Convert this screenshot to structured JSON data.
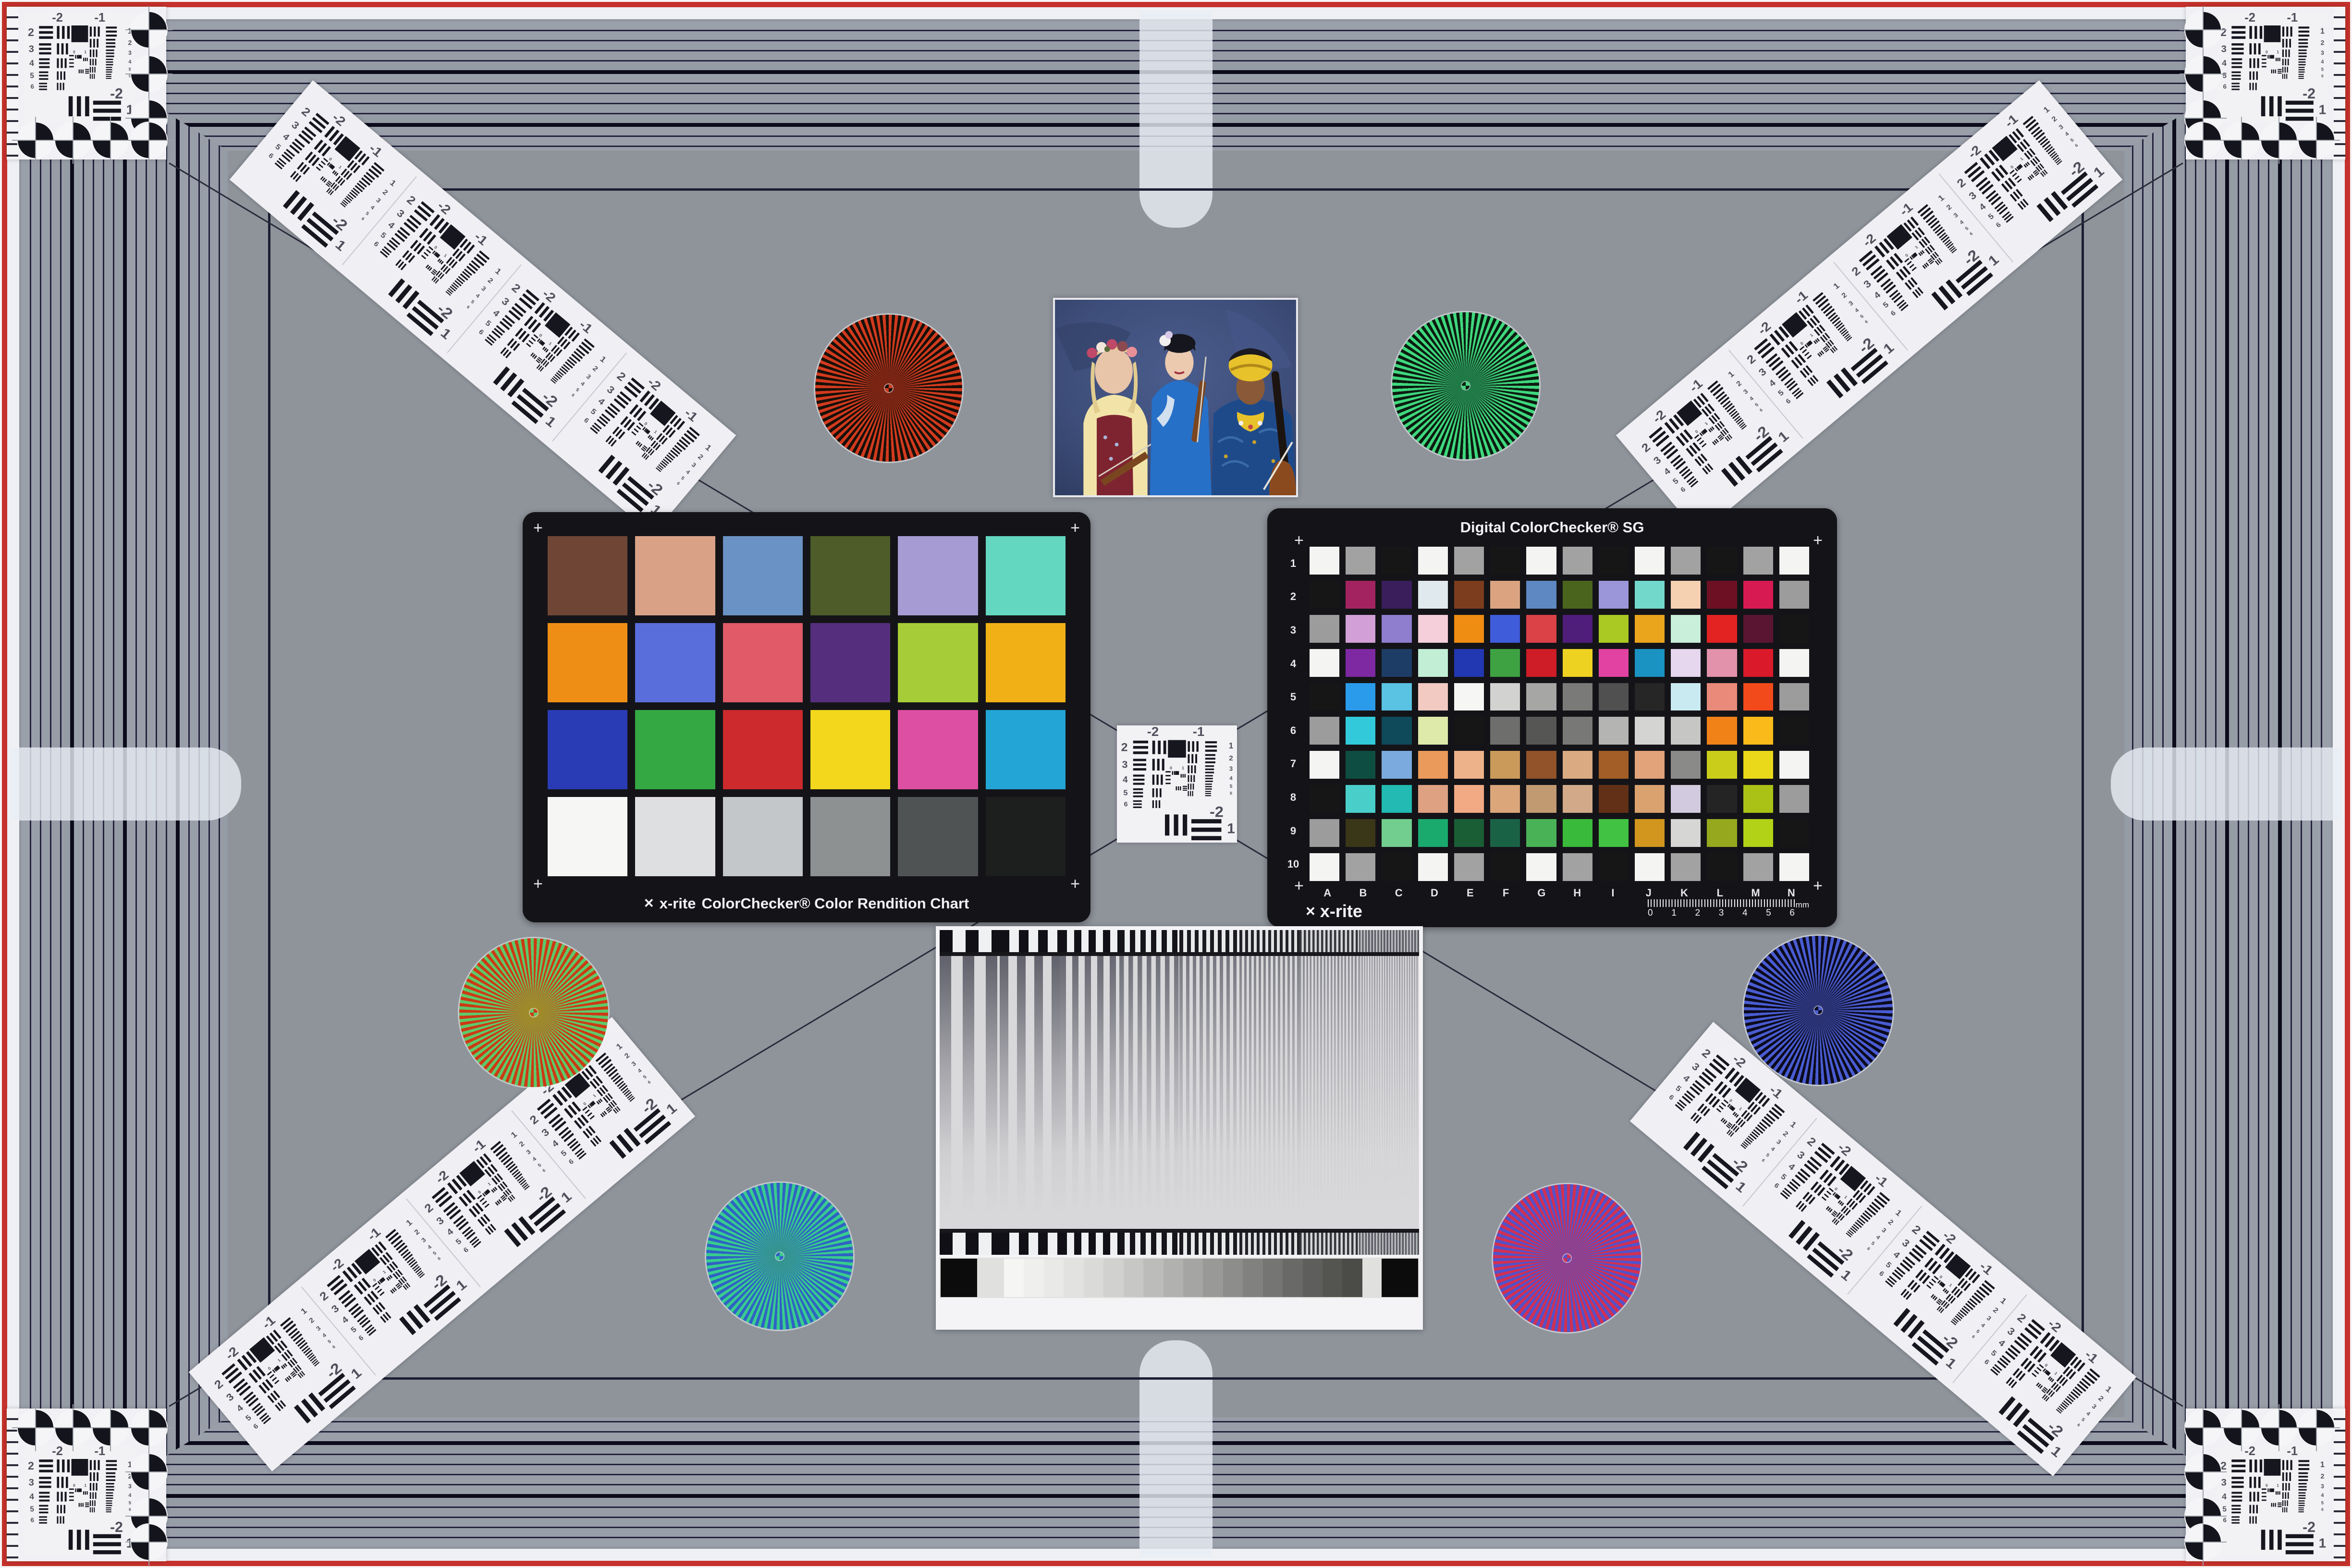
{
  "scene": {
    "background": "#8f949b",
    "border_red": "#c5312c",
    "frame_stripe": "#9aa0aa",
    "frame_line": "#23233d",
    "panel_white": "#f1f0f4"
  },
  "stars": [
    {
      "name": "red-black-star",
      "c1": "#d23a1e",
      "c2": "#171009",
      "blend": "#7a2414"
    },
    {
      "name": "green-black-star",
      "c1": "#3fd87e",
      "c2": "#0c1c10",
      "blend": "#1f7a46"
    },
    {
      "name": "red-green-star",
      "c1": "#cc3a14",
      "c2": "#5ec96a",
      "blend": "#a08a28"
    },
    {
      "name": "green-blue-star",
      "c1": "#38cc8e",
      "c2": "#2f62c4",
      "blend": "#35948f"
    },
    {
      "name": "blue-black-star",
      "c1": "#4a5cd2",
      "c2": "#0b0b1e",
      "blend": "#2a3274"
    },
    {
      "name": "red-blue-star",
      "c1": "#d23052",
      "c2": "#5252ca",
      "blend": "#8c4290"
    }
  ],
  "classic_chart": {
    "logo": "x-rite",
    "caption": "ColorChecker® Color Rendition Chart",
    "patches": [
      "#6f4636",
      "#d9a287",
      "#6a92c4",
      "#4d5c28",
      "#a79bd3",
      "#63d7c0",
      "#ef8e15",
      "#5a6edb",
      "#e05a68",
      "#552f7e",
      "#a6cd37",
      "#f0b016",
      "#2a3cb5",
      "#33a843",
      "#cc2a2d",
      "#f2d71c",
      "#dd4fa2",
      "#23a5d5",
      "#f6f6f4",
      "#dedfe1",
      "#c3c7c9",
      "#8d9192",
      "#4f5354",
      "#1d1e1e"
    ]
  },
  "sg_chart": {
    "title": "Digital ColorChecker® SG",
    "logo": "x-rite",
    "rows": [
      "1",
      "2",
      "3",
      "4",
      "5",
      "6",
      "7",
      "8",
      "9",
      "10"
    ],
    "cols": [
      "A",
      "B",
      "C",
      "D",
      "E",
      "F",
      "G",
      "H",
      "I",
      "J",
      "K",
      "L",
      "M",
      "N"
    ],
    "ruler_numbers": [
      "0",
      "1",
      "2",
      "3",
      "4",
      "5",
      "6"
    ],
    "ruler_unit": "mm",
    "patches": [
      "#f4f4f2",
      "#a2a2a2",
      "#161616",
      "#f4f4f2",
      "#a2a2a2",
      "#161616",
      "#f4f4f2",
      "#a2a2a2",
      "#161616",
      "#f4f4f2",
      "#a2a2a2",
      "#161616",
      "#a2a2a2",
      "#f4f4f2",
      "#161616",
      "#a32360",
      "#3a1e5c",
      "#dfe9ee",
      "#7c3d1e",
      "#dba380",
      "#5e88c2",
      "#4a641e",
      "#9b96da",
      "#72d8cc",
      "#f5d1b2",
      "#6e1024",
      "#d81a52",
      "#9c9c9c",
      "#9c9c9c",
      "#d2a0d6",
      "#8f7dce",
      "#f5d0da",
      "#ef8c12",
      "#3f5cda",
      "#da4248",
      "#4f1d7a",
      "#aac922",
      "#eaa51c",
      "#c9eed9",
      "#e32222",
      "#5a1532",
      "#161616",
      "#f4f4f2",
      "#7e28a2",
      "#1d3d66",
      "#c2eed6",
      "#2238b2",
      "#3ea242",
      "#ce1d26",
      "#eed222",
      "#e242a2",
      "#1a92c2",
      "#e6d6ee",
      "#e292aa",
      "#da1a2a",
      "#f4f4f2",
      "#161616",
      "#2a9aea",
      "#5ac2e2",
      "#f2cac2",
      "#f6f6f4",
      "#d2d2d0",
      "#a6a6a4",
      "#7a7a78",
      "#505050",
      "#262626",
      "#caeaf2",
      "#ea8a7a",
      "#f24a1a",
      "#9c9c9c",
      "#9c9c9c",
      "#32cada",
      "#0e4a5a",
      "#deeaaa",
      "#161616",
      "#6e6e6c",
      "#565654",
      "#787876",
      "#b4b4b2",
      "#d4d4d2",
      "#c6c6c4",
      "#f08218",
      "#f9ba1a",
      "#161616",
      "#f4f4f2",
      "#0e4e42",
      "#7aaade",
      "#ea9a5a",
      "#eeb28a",
      "#ca9a5a",
      "#92522a",
      "#daaa82",
      "#a25e26",
      "#e2a27a",
      "#8a8a88",
      "#cace1a",
      "#ead81a",
      "#f4f4f2",
      "#161616",
      "#4aceca",
      "#22bab2",
      "#dea282",
      "#f2aa84",
      "#daa67a",
      "#c29a72",
      "#d2aa8a",
      "#623016",
      "#daa26e",
      "#d2cade",
      "#242424",
      "#aac216",
      "#9c9c9c",
      "#9c9c9c",
      "#3a3618",
      "#72ce8e",
      "#1aaa6e",
      "#1a5e36",
      "#1a6246",
      "#4ab256",
      "#3aba3a",
      "#42c242",
      "#d2961e",
      "#d6d6d4",
      "#96a81e",
      "#b2d218",
      "#161616",
      "#f4f4f2",
      "#a2a2a2",
      "#161616",
      "#f4f4f2",
      "#a2a2a2",
      "#161616",
      "#f4f4f2",
      "#a2a2a2",
      "#161616",
      "#f4f4f2",
      "#a2a2a2",
      "#161616",
      "#a2a2a2",
      "#f4f4f2"
    ]
  },
  "usaf": {
    "top_left_label": "-2",
    "top_right_label": "-1",
    "left_labels": [
      "2",
      "3",
      "4",
      "5",
      "6"
    ],
    "right_labels": [
      "1",
      "2",
      "3",
      "4",
      "5",
      "6"
    ],
    "bottom_labels": [
      "-2",
      "1"
    ],
    "mini_labels": [
      "0",
      "1"
    ]
  },
  "sweep": {
    "steps": [
      "#f5f5f3",
      "#efefed",
      "#e9e9e7",
      "#e2e2e0",
      "#dadad8",
      "#d1d1cf",
      "#c7c7c5",
      "#bcbcba",
      "#b1b1af",
      "#a5a5a3",
      "#999997",
      "#8d8d8b",
      "#81817f",
      "#757573",
      "#696967",
      "#5e5e5c",
      "#545450",
      "#4b4b47"
    ]
  },
  "photo": {
    "palette": {
      "backdrop": "#3e4e7a",
      "skin_light": "#e8c4a8",
      "skin_mid": "#eccab0",
      "skin_deep": "#8a5a38",
      "blouse": "#f2e4a8",
      "vest": "#7e2430",
      "kimono": "#2670c8",
      "robe": "#1e4a8a",
      "turban": "#e8c22a",
      "hair_blonde": "#e2cc8e",
      "hair_black": "#16161e",
      "violin": "#7a4620"
    }
  }
}
